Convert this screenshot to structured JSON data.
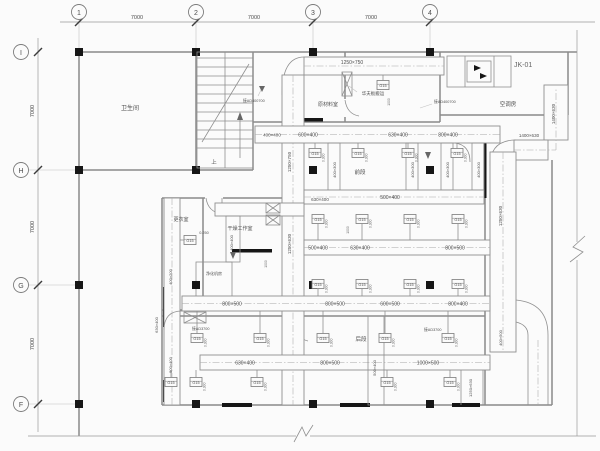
{
  "grid": {
    "dim": "7000",
    "top": [
      "1",
      "2",
      "3",
      "4"
    ],
    "left": [
      "I",
      "H",
      "G",
      "F"
    ]
  },
  "rooms": {
    "toilet": "卫生间",
    "raw_material": "原材料室",
    "waffle": "华夫板搬运",
    "ac_room": "空调房",
    "changing": "更衣室",
    "drying": "干燥工作室",
    "purification": "净化机房",
    "front": "前段",
    "rear": "后段",
    "stair_up": "上"
  },
  "equipment": {
    "ahu": "JK-01"
  },
  "diffuser": {
    "tag": "G15",
    "flow": "0.300",
    "flow_alt": "0.250"
  },
  "stubs": {
    "a": "接AD400700",
    "b": "接AD3700"
  },
  "ducts": {
    "h0": "1250×750",
    "v1_up": "1250×750",
    "v1_dn": "1250×630",
    "v2": "1250×630",
    "v2_end": "400×500",
    "v2_drop": "1250×630",
    "h2": "1400×630",
    "riser": "1400×630",
    "a1": "400×400",
    "a2": "600×400",
    "a3": "630×400",
    "a4": "800×400",
    "drop": "400×300",
    "b1": "630×400",
    "b2": "500×400",
    "vb": "400×400",
    "v_ch": "400×200",
    "c1": "500×400",
    "c2": "630×400",
    "c3": "800×500",
    "d1": "800×500",
    "d2": "800×500",
    "d3": "600×500",
    "d4": "800×400",
    "e1": "630×400",
    "e2": "800×500",
    "e3": "1000×500",
    "v_l1": "630×400",
    "v_l2": "500×400",
    "v3": "500×400",
    "mm": "1000"
  }
}
